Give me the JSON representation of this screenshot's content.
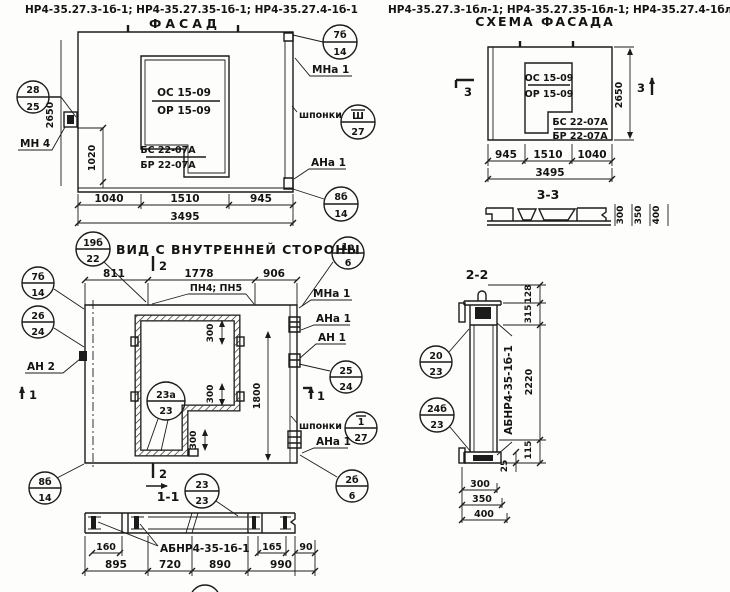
{
  "meta": {
    "bg": "#fdfdfb",
    "ink": "#1b1b1b"
  },
  "header_left": "НР4-35.27.3-1б-1; НР4-35.27.35-1б-1; НР4-35.27.4-1б-1",
  "header_right": "НР4-35.27.3-1бл-1; НР4-35.27.35-1бл-1; НР4-35.27.4-1бл-1",
  "facade": {
    "title": "ФАСАД",
    "win_top": "ОС 15-09",
    "win_bot": "ОР 15-09",
    "sill_top": "БС 22-07А",
    "sill_bot": "БР 22-07А",
    "dim_height": "2650",
    "dim_1020": "1020",
    "dim_a": "1040",
    "dim_b": "1510",
    "dim_c": "945",
    "dim_total": "3495",
    "lbl_mn4": "МН 4",
    "lbl_mna1": "МНа 1",
    "lbl_shponki": "шпонки",
    "lbl_ana1": "АНа 1"
  },
  "inner": {
    "title": "ВИД С ВНУТРЕННЕЙ СТОРОНЫ",
    "dim_a": "811",
    "dim_b": "1778",
    "dim_c": "906",
    "lbl_pn": "ПН4; ПН5",
    "lbl_mna1": "МНа 1",
    "lbl_ana1_top": "АНа 1",
    "lbl_an1": "АН 1",
    "lbl_an2": "АН 2",
    "lbl_shponki": "шпонки",
    "lbl_ana1_bot": "АНа 1",
    "dim_300a": "300",
    "dim_300b": "300",
    "dim_300c": "300",
    "dim_1800": "1800",
    "marker_1": "1",
    "marker_2": "2"
  },
  "sec11": {
    "title": "1-1",
    "marker_2": "2",
    "label": "АБНР4-35-1б-1",
    "dim_160": "160",
    "dim_165": "165",
    "dim_90": "90",
    "dim_a": "895",
    "dim_b": "720",
    "dim_c": "890",
    "dim_d": "990"
  },
  "schema": {
    "title": "СХЕМА ФАСАДА",
    "win_top": "ОС 15-09",
    "win_bot": "ОР 15-09",
    "sill_top": "БС 22-07А",
    "sill_bot": "БР 22-07А",
    "dim_a": "945",
    "dim_b": "1510",
    "dim_c": "1040",
    "dim_total": "3495",
    "dim_height": "2650",
    "marker_3": "3",
    "sec_title": "3-3",
    "t300": "300",
    "t350": "350",
    "t400": "400"
  },
  "sec22": {
    "title": "2-2",
    "label": "АБНР4-35-1б-1",
    "dim_128": "128",
    "dim_315": "315",
    "dim_2220": "2220",
    "dim_115": "115",
    "dim_25": "25",
    "dim_300": "300",
    "dim_350": "350",
    "dim_400": "400"
  },
  "callouts": {
    "c28_25": {
      "t": "28",
      "b": "25"
    },
    "c7b_14": {
      "t": "7б",
      "b": "14"
    },
    "cSh_27": {
      "t": "Ш",
      "b": "27"
    },
    "c8b_14": {
      "t": "8б",
      "b": "14"
    },
    "c19b_22": {
      "t": "19б",
      "b": "22"
    },
    "c26_24": {
      "t": "26",
      "b": "24"
    },
    "c1a_6": {
      "t": "1а",
      "b": "6"
    },
    "c25_24": {
      "t": "25",
      "b": "24"
    },
    "c1_27": {
      "t": "1",
      "b": "27"
    },
    "c2b_6": {
      "t": "2б",
      "b": "6"
    },
    "c23a_23": {
      "t": "23а",
      "b": "23"
    },
    "c23_23": {
      "t": "23",
      "b": "23"
    },
    "c20_23": {
      "t": "20",
      "b": "23"
    },
    "c24b_23": {
      "t": "24б",
      "b": "23"
    }
  }
}
